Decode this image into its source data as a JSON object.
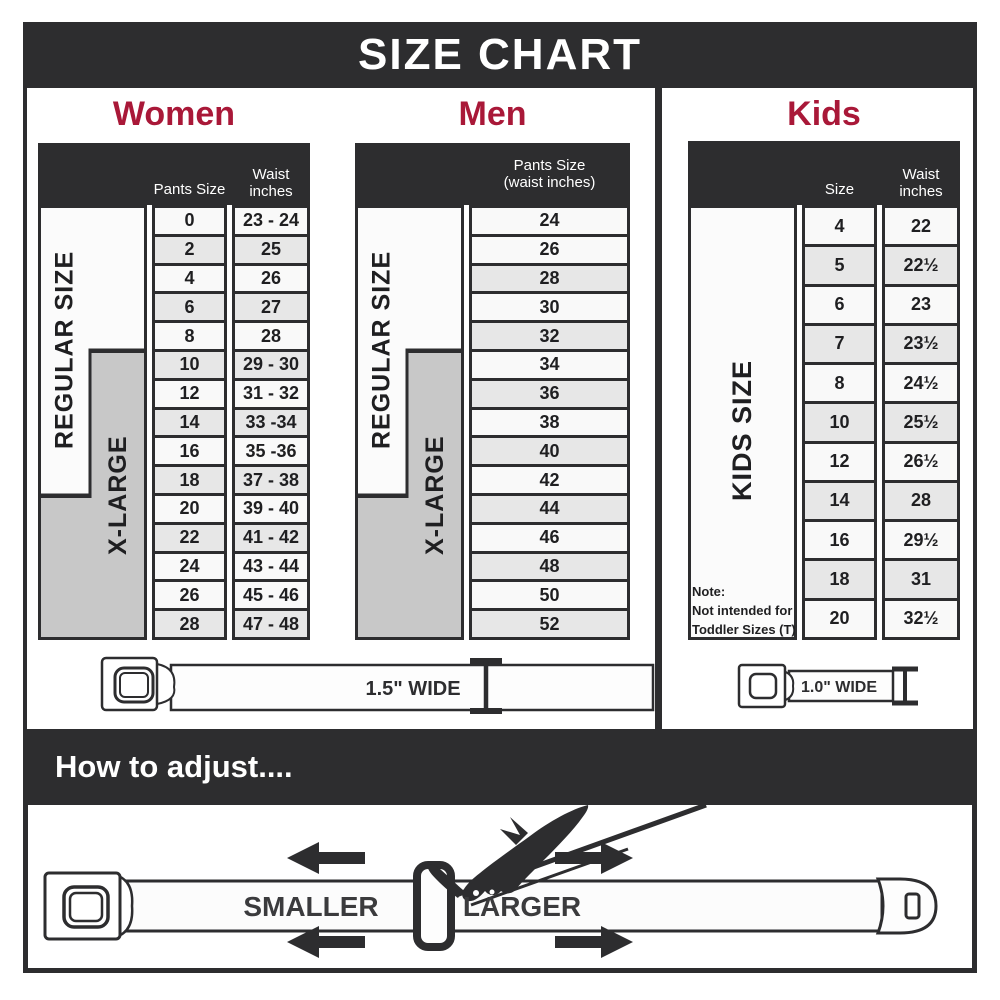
{
  "header": {
    "title": "SIZE CHART"
  },
  "colors": {
    "dark": "#2d2d2f",
    "accent": "#a91838",
    "row_light": "#f9f9f9",
    "row_shaded": "#e7e7e7",
    "box_white": "#fbfbfb",
    "label_gray": "#c8c8c8",
    "ink": "#1f1f21",
    "text_gray": "#3b3b3d"
  },
  "women": {
    "title": "Women",
    "col_headers": {
      "size": "Pants Size",
      "waist": "Waist\ninches"
    },
    "labels": {
      "regular": "REGULAR SIZE",
      "xlarge": "X-LARGE"
    },
    "belt_label": "1.5\" WIDE",
    "rows": [
      {
        "size": "0",
        "waist": "23 - 24",
        "shaded": false
      },
      {
        "size": "2",
        "waist": "25",
        "shaded": true
      },
      {
        "size": "4",
        "waist": "26",
        "shaded": false
      },
      {
        "size": "6",
        "waist": "27",
        "shaded": true
      },
      {
        "size": "8",
        "waist": "28",
        "shaded": false
      },
      {
        "size": "10",
        "waist": "29 - 30",
        "shaded": true
      },
      {
        "size": "12",
        "waist": "31 - 32",
        "shaded": false
      },
      {
        "size": "14",
        "waist": "33 -34",
        "shaded": true
      },
      {
        "size": "16",
        "waist": "35 -36",
        "shaded": false
      },
      {
        "size": "18",
        "waist": "37 - 38",
        "shaded": true
      },
      {
        "size": "20",
        "waist": "39 - 40",
        "shaded": false
      },
      {
        "size": "22",
        "waist": "41 - 42",
        "shaded": true
      },
      {
        "size": "24",
        "waist": "43 - 44",
        "shaded": false
      },
      {
        "size": "26",
        "waist": "45 - 46",
        "shaded": false
      },
      {
        "size": "28",
        "waist": "47 - 48",
        "shaded": true
      }
    ]
  },
  "men": {
    "title": "Men",
    "col_headers": {
      "size": "Pants Size\n(waist inches)"
    },
    "labels": {
      "regular": "REGULAR SIZE",
      "xlarge": "X-LARGE"
    },
    "rows": [
      {
        "size": "24",
        "shaded": false
      },
      {
        "size": "26",
        "shaded": false
      },
      {
        "size": "28",
        "shaded": true
      },
      {
        "size": "30",
        "shaded": false
      },
      {
        "size": "32",
        "shaded": true
      },
      {
        "size": "34",
        "shaded": false
      },
      {
        "size": "36",
        "shaded": true
      },
      {
        "size": "38",
        "shaded": false
      },
      {
        "size": "40",
        "shaded": true
      },
      {
        "size": "42",
        "shaded": false
      },
      {
        "size": "44",
        "shaded": true
      },
      {
        "size": "46",
        "shaded": false
      },
      {
        "size": "48",
        "shaded": true
      },
      {
        "size": "50",
        "shaded": false
      },
      {
        "size": "52",
        "shaded": true
      }
    ]
  },
  "kids": {
    "title": "Kids",
    "col_headers": {
      "size": "Size",
      "waist": "Waist\ninches"
    },
    "labels": {
      "kids": "KIDS SIZE"
    },
    "note": "Note:\nNot intended for\nToddler Sizes (T)",
    "belt_label": "1.0\" WIDE",
    "rows": [
      {
        "size": "4",
        "waist": "22",
        "shaded": false
      },
      {
        "size": "5",
        "waist": "22½",
        "shaded": true
      },
      {
        "size": "6",
        "waist": "23",
        "shaded": false
      },
      {
        "size": "7",
        "waist": "23½",
        "shaded": true
      },
      {
        "size": "8",
        "waist": "24½",
        "shaded": false
      },
      {
        "size": "10",
        "waist": "25½",
        "shaded": true
      },
      {
        "size": "12",
        "waist": "26½",
        "shaded": false
      },
      {
        "size": "14",
        "waist": "28",
        "shaded": true
      },
      {
        "size": "16",
        "waist": "29½",
        "shaded": false
      },
      {
        "size": "18",
        "waist": "31",
        "shaded": true
      },
      {
        "size": "20",
        "waist": "32½",
        "shaded": false
      }
    ]
  },
  "adjust": {
    "title": "How to adjust....",
    "smaller": "SMALLER",
    "larger": "LARGER"
  }
}
